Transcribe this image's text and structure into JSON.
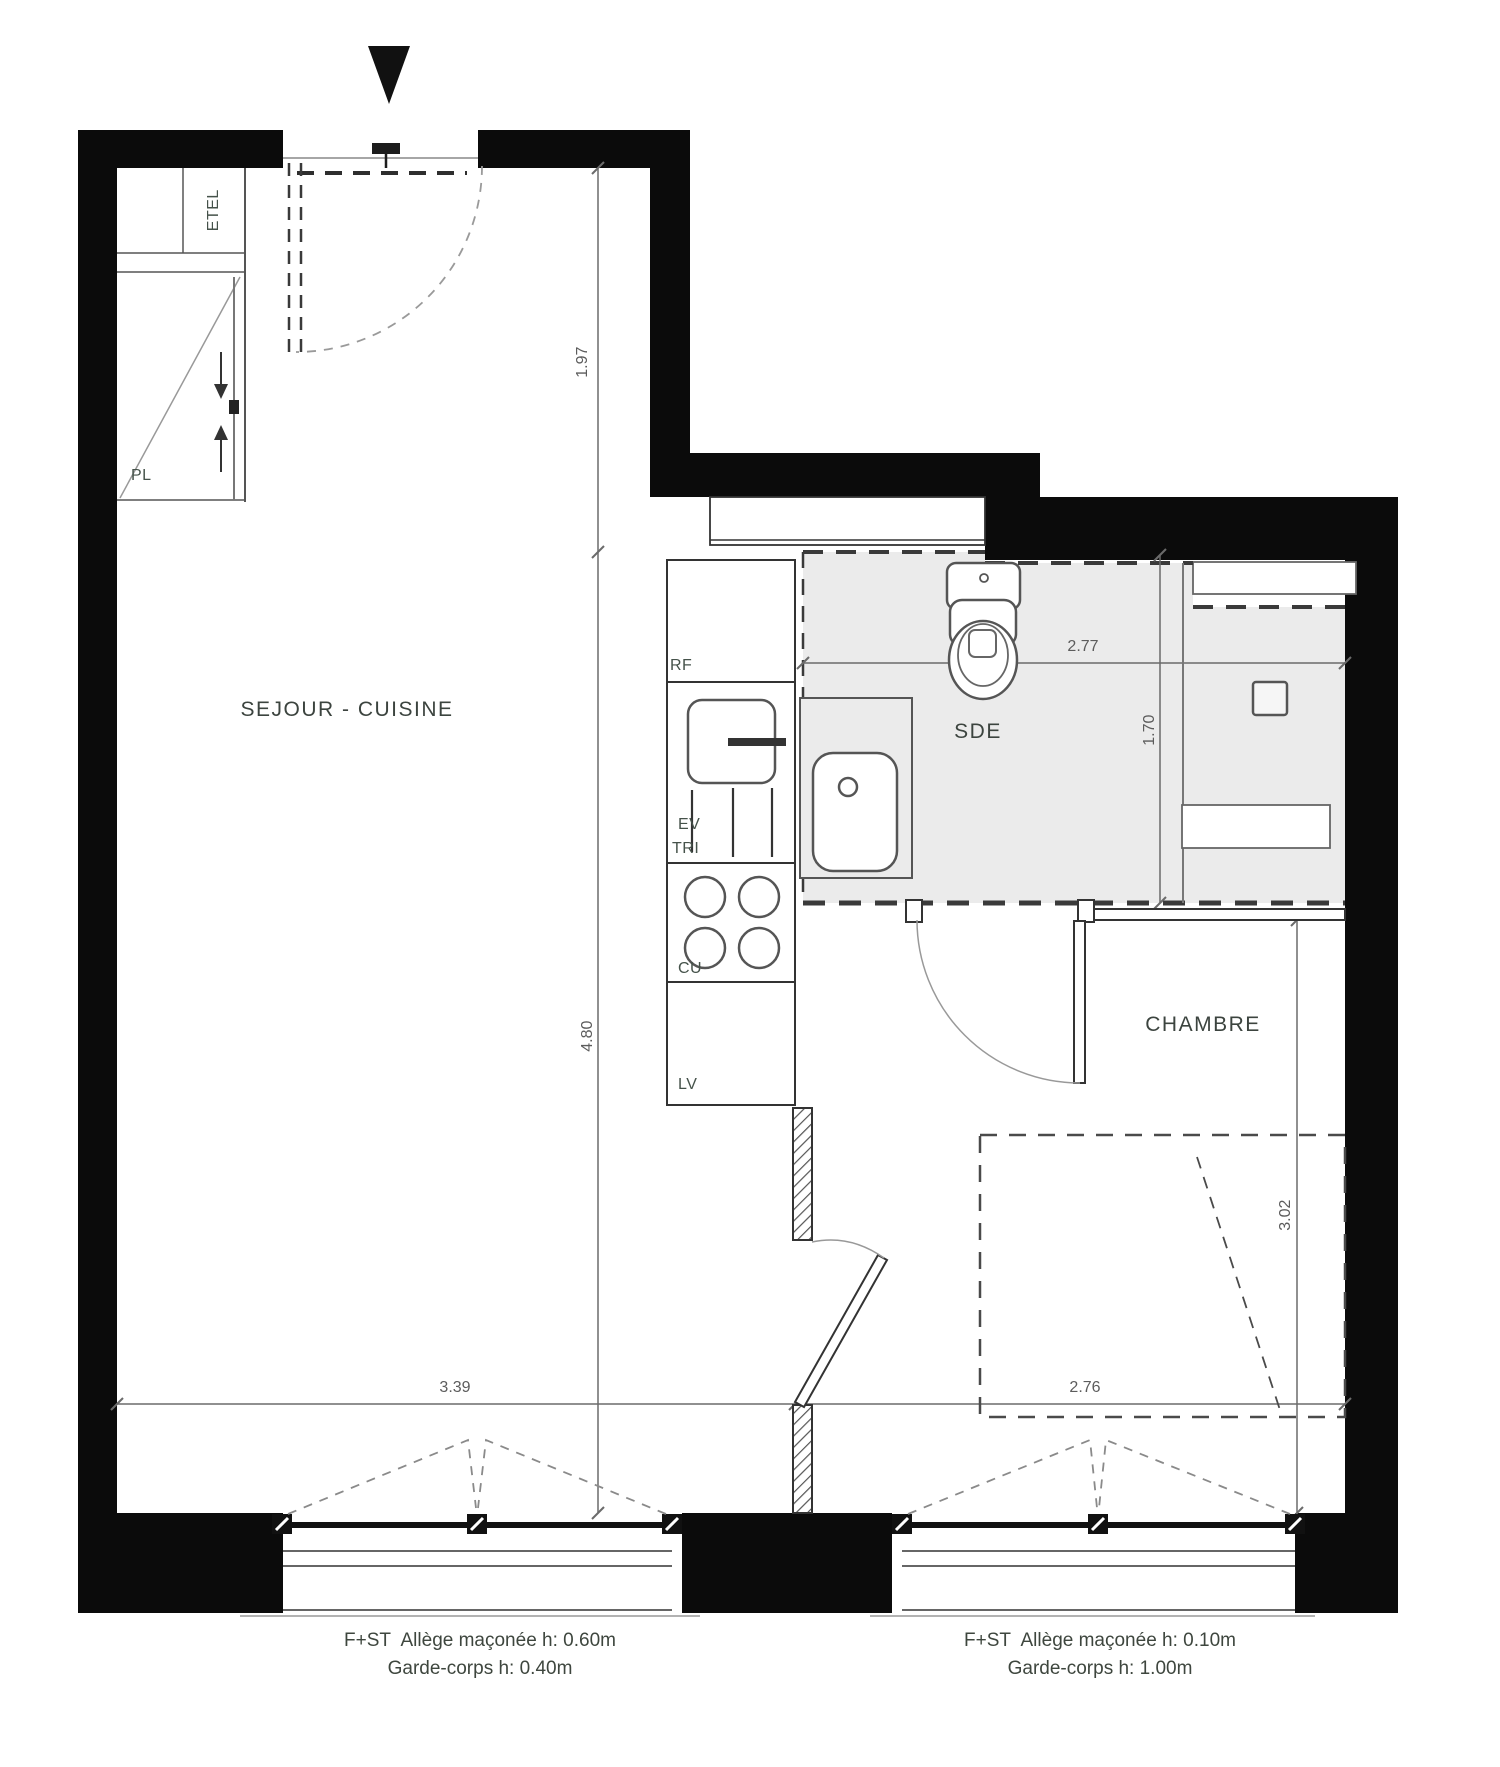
{
  "rooms": {
    "sejour": {
      "label": "SEJOUR - CUISINE"
    },
    "sde": {
      "label": "SDE"
    },
    "chambre": {
      "label": "CHAMBRE"
    }
  },
  "closet": {
    "pl": "PL",
    "etel": "ETEL"
  },
  "kitchen": {
    "rf": "RF",
    "ev": "EV",
    "tri": "TRI",
    "cu": "CU",
    "lv": "LV"
  },
  "dimensions": {
    "d197": "1.97",
    "d480": "4.80",
    "d277": "2.77",
    "d170": "1.70",
    "d302": "3.02",
    "d339": "3.39",
    "d276": "2.76"
  },
  "notes": {
    "left": {
      "line1": "F+ST  Allège maçonée h: 0.60m",
      "line2": "Garde-corps h: 0.40m"
    },
    "right": {
      "line1": "F+ST  Allège maçonée h: 0.10m",
      "line2": "Garde-corps h: 1.00m"
    }
  },
  "colors": {
    "wall": "#0b0b0b",
    "wet_floor": "#ebebeb",
    "line": "#555555",
    "dim_text": "#5c5c5c",
    "label_text": "#3d433f"
  }
}
